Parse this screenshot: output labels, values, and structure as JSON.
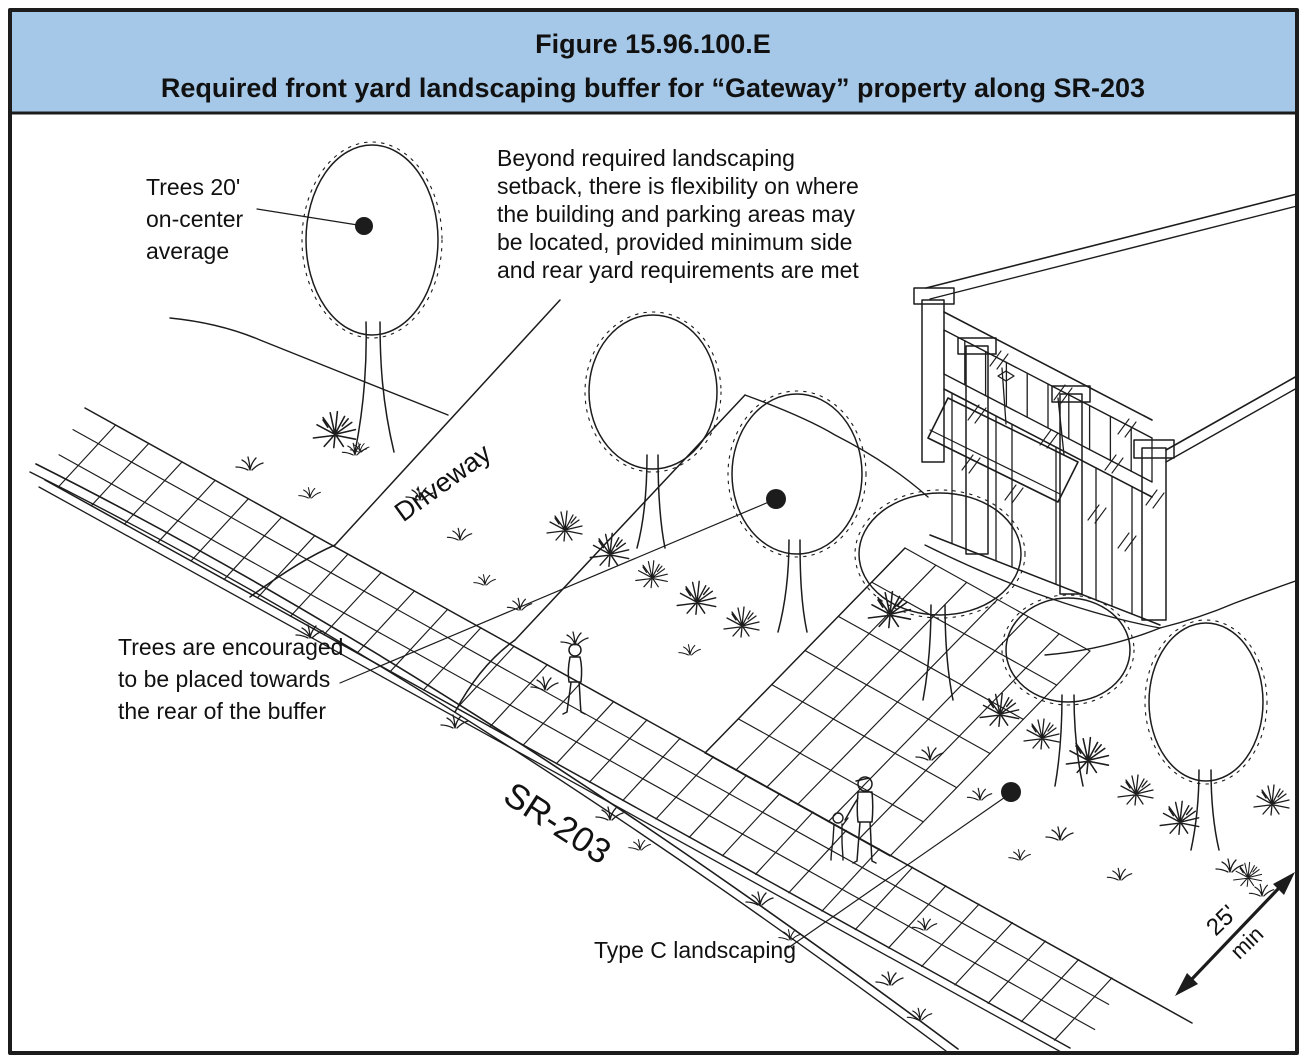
{
  "header": {
    "bg": "#a6c8e8",
    "line1": "Figure 15.96.100.E",
    "line2": "Required front yard landscaping buffer for “Gateway” property along SR-203"
  },
  "annotations": {
    "trees_spacing": {
      "lines": [
        "Trees 20'",
        "on-center",
        "average"
      ]
    },
    "flexibility_note": {
      "lines": [
        "Beyond required landscaping",
        "setback, there is flexibility on where",
        "the building and parking areas may",
        "be located, provided minimum side",
        "and rear yard requirements are met"
      ]
    },
    "trees_rear": {
      "lines": [
        "Trees are encouraged",
        "to be placed towards",
        "the rear of the buffer"
      ]
    },
    "type_c_label": "Type C landscaping",
    "driveway_label": "Driveway",
    "street_label": "SR-203",
    "dimension": {
      "value": "25'",
      "qualifier": "min"
    }
  },
  "drawing": {
    "ink": "#1c1c1c",
    "paper": "#ffffff",
    "depicts": "Isometric sketch of SR-203 street with curb, planting verge, scored sidewalk, driveway, Type C landscaping buffer with street trees and shrubs, storefront building with awning, pedestrians, and a 25-foot minimum buffer dimension arrow"
  }
}
